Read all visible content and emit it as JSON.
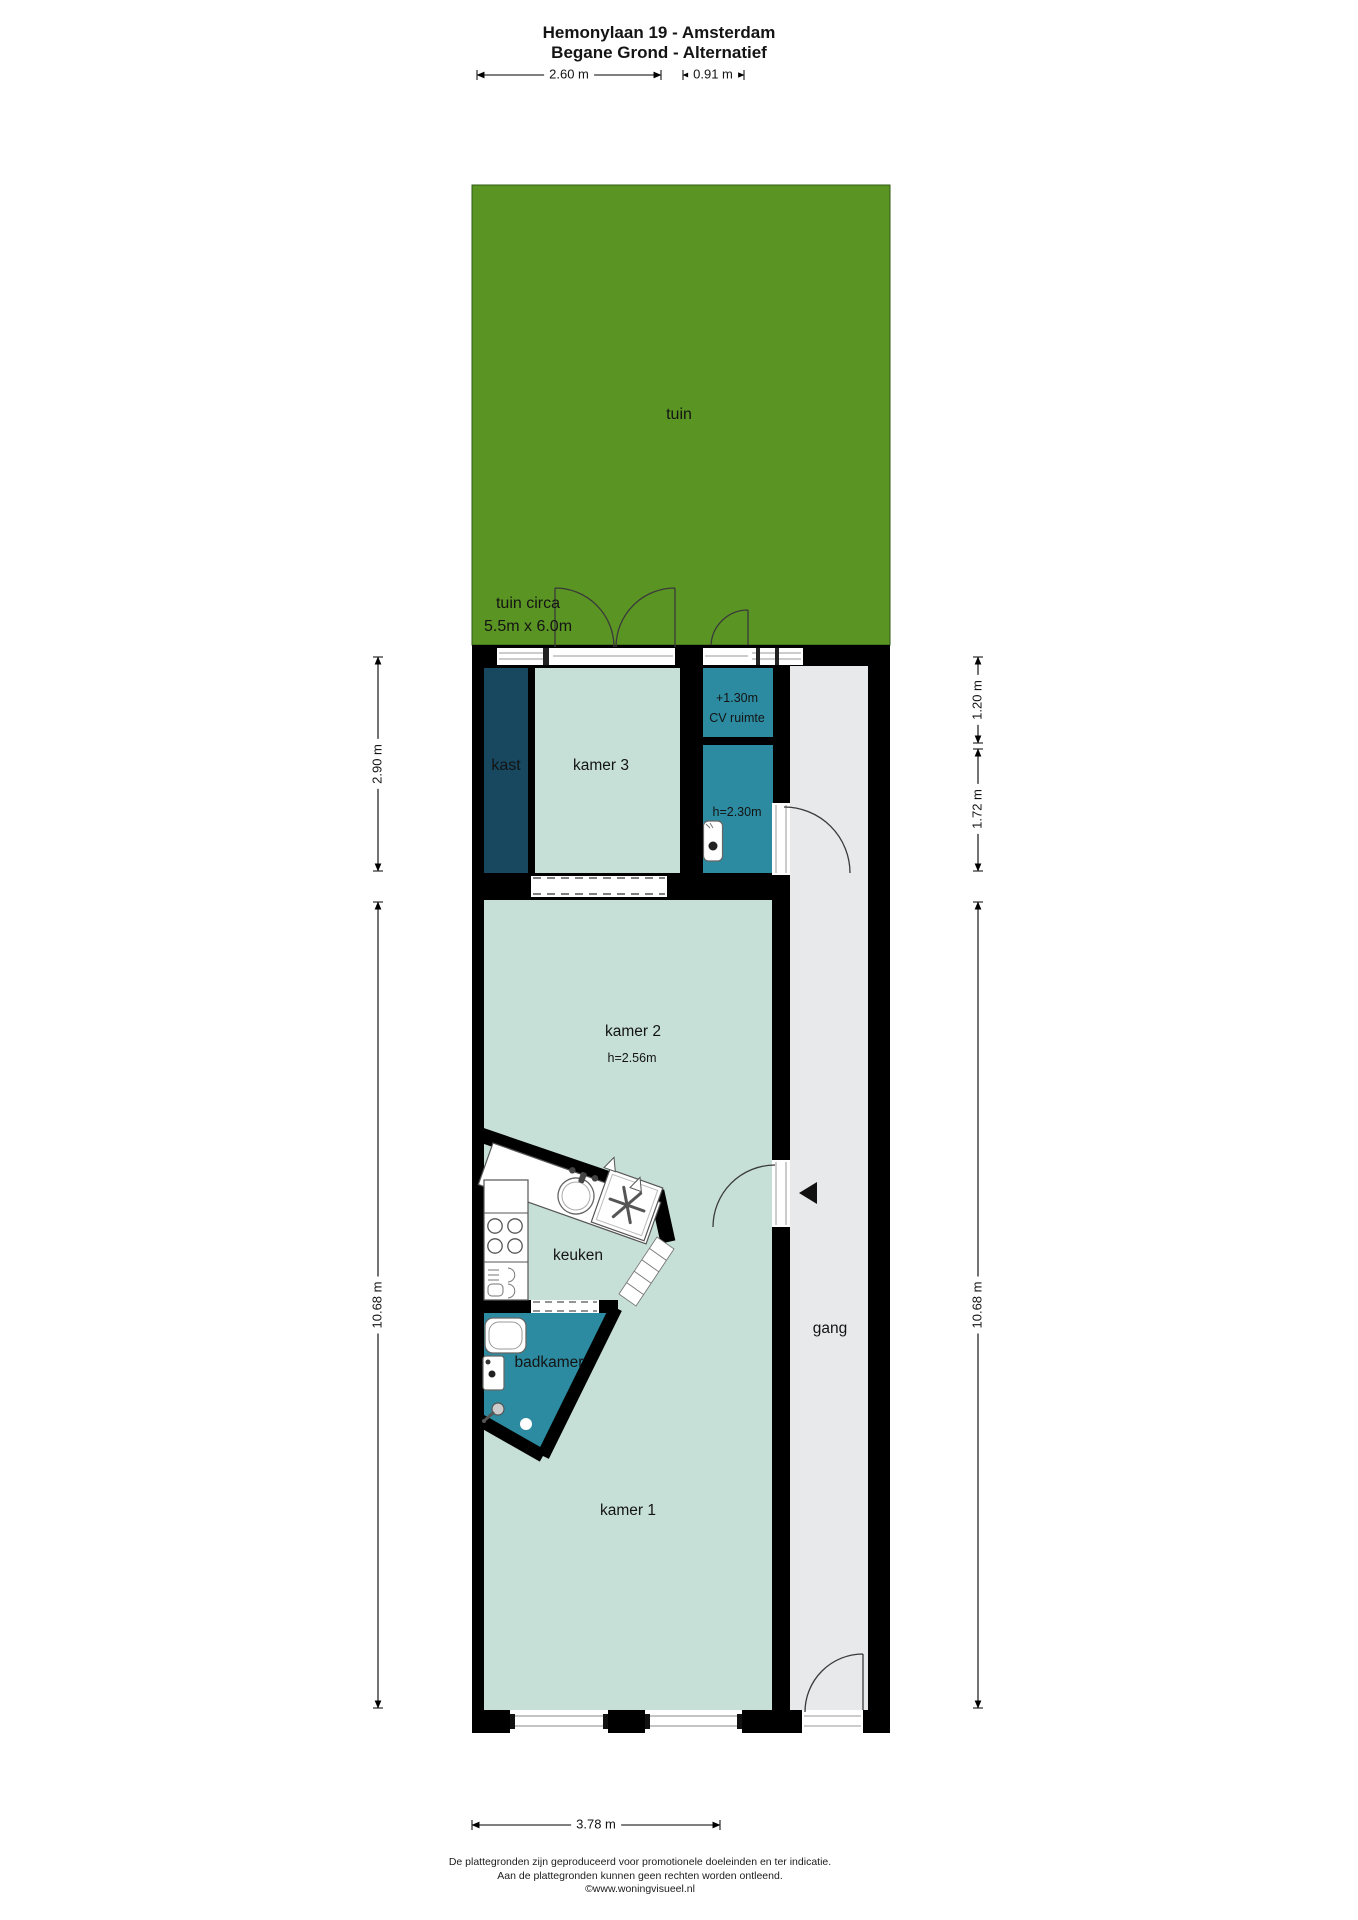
{
  "title": {
    "line1": "Hemonylaan 19 - Amsterdam",
    "line2": "Begane Grond - Alternatief"
  },
  "garden": {
    "label": "tuin",
    "note_line1": "tuin circa",
    "note_line2": "5.5m x 6.0m"
  },
  "rooms": {
    "kast": "kast",
    "kamer3": "kamer 3",
    "cv_level": "+1.30m",
    "cv": "CV ruimte",
    "toilet_height": "h=2.30m",
    "kamer2": "kamer 2",
    "kamer2_height": "h=2.56m",
    "keuken": "keuken",
    "badkamer": "badkamer",
    "kamer1": "kamer 1",
    "gang": "gang"
  },
  "dimensions": {
    "top_kamer3": "2.60 m",
    "top_cv": "0.91 m",
    "left_upper": "2.90 m",
    "left_lower": "10.68 m",
    "right_upper": "1.20 m",
    "right_middle": "1.72 m",
    "right_lower": "10.68 m",
    "bottom": "3.78 m"
  },
  "footer": {
    "line1": "De plattegronden zijn geproduceerd voor promotionele doeleinden en ter indicatie.",
    "line2": "Aan de plattegronden kunnen geen rechten worden ontleend.",
    "line3": "©www.woningvisueel.nl"
  },
  "colors": {
    "garden-green": "#5a9423",
    "room-mint": "#c6e0d8",
    "wet-teal": "#2c8ba0",
    "closet-navy": "#17485f",
    "hall-gray": "#e8e9ea",
    "wall-black": "#000000"
  }
}
